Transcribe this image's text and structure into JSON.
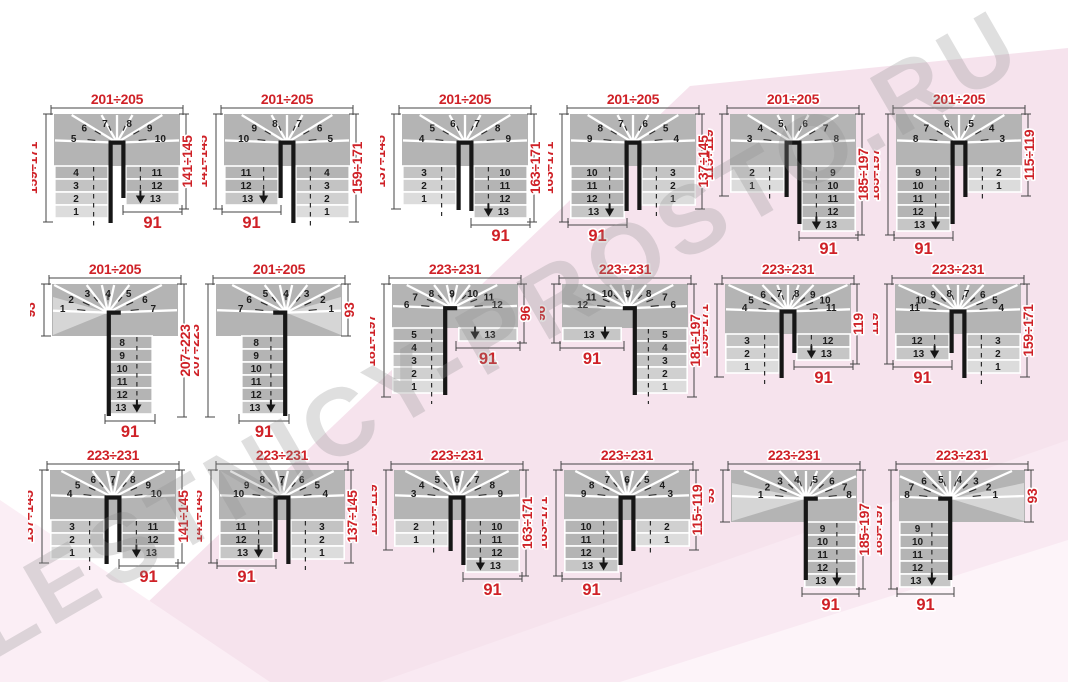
{
  "watermark": "LESTNICY-PROSTO.RU",
  "colors": {
    "red": "#cf2127",
    "step": "#b4b4b4",
    "step_light1": "#dcdcdc",
    "step_light2": "#d0d0d0",
    "step_light3": "#c3c3c3",
    "exit_step": "#c6c6c6",
    "wedge_light": "#d6d6d6",
    "black": "#161616",
    "pink": "#f6e3ed",
    "pink_light": "#fbeef5"
  },
  "diagrams": [
    {
      "id": "d1",
      "kind": "U",
      "pos": [
        32,
        84
      ],
      "band_h": 52,
      "winders": [
        5,
        6,
        7,
        8,
        9,
        10
      ],
      "left_rows": [
        4,
        3,
        2,
        1
      ],
      "left_exit": false,
      "right_rows": [
        11,
        12
      ],
      "right_exit": true,
      "exit_step": 13,
      "dims": {
        "top": "201÷205",
        "left": "159÷171",
        "right": "141÷145",
        "bottom": "91"
      }
    },
    {
      "id": "d2",
      "kind": "U",
      "pos": [
        202,
        84
      ],
      "band_h": 52,
      "winders": [
        10,
        9,
        8,
        7,
        6,
        5
      ],
      "left_rows": [
        11,
        12
      ],
      "left_exit": true,
      "right_rows": [
        4,
        3,
        2,
        1
      ],
      "right_exit": false,
      "exit_step": 13,
      "dims": {
        "top": "201÷205",
        "left": "141÷145",
        "right": "159÷171",
        "bottom": "91"
      }
    },
    {
      "id": "d3",
      "kind": "U",
      "pos": [
        380,
        84
      ],
      "band_h": 52,
      "winders": [
        4,
        5,
        6,
        7,
        8,
        9
      ],
      "left_rows": [
        3,
        2,
        1
      ],
      "left_exit": false,
      "right_rows": [
        10,
        11,
        12
      ],
      "right_exit": true,
      "exit_step": 13,
      "dims": {
        "top": "201÷205",
        "left": "137÷145",
        "right": "163÷171",
        "bottom": "91"
      }
    },
    {
      "id": "d4",
      "kind": "U",
      "pos": [
        548,
        84
      ],
      "band_h": 52,
      "winders": [
        9,
        8,
        7,
        6,
        5,
        4
      ],
      "left_rows": [
        10,
        11,
        12
      ],
      "left_exit": true,
      "right_rows": [
        3,
        2,
        1
      ],
      "right_exit": false,
      "exit_step": 13,
      "dims": {
        "top": "201÷205",
        "left": "163÷171",
        "right": "137÷145",
        "bottom": "91"
      }
    },
    {
      "id": "d5",
      "kind": "U",
      "pos": [
        708,
        84
      ],
      "band_h": 52,
      "winders": [
        3,
        4,
        5,
        6,
        7,
        8
      ],
      "left_rows": [
        2,
        1
      ],
      "left_exit": false,
      "right_rows": [
        9,
        10,
        11,
        12
      ],
      "right_exit": true,
      "exit_step": 13,
      "dims": {
        "top": "201÷205",
        "left": "115÷119",
        "right": "185÷197",
        "bottom": "91"
      }
    },
    {
      "id": "d6",
      "kind": "U",
      "pos": [
        874,
        84
      ],
      "band_h": 52,
      "winders": [
        8,
        7,
        6,
        5,
        4,
        3
      ],
      "left_rows": [
        9,
        10,
        11,
        12
      ],
      "left_exit": true,
      "right_rows": [
        2,
        1
      ],
      "right_exit": false,
      "exit_step": 13,
      "dims": {
        "top": "201÷205",
        "left": "185÷197",
        "right": "115÷119",
        "bottom": "91"
      }
    },
    {
      "id": "d7",
      "kind": "Lh",
      "pos": [
        30,
        254
      ],
      "band_h": 52,
      "winders": [
        1,
        2,
        3,
        4,
        5,
        6,
        7
      ],
      "flight_side": "right",
      "flight_rows": [
        8,
        9,
        10,
        11,
        12
      ],
      "light_entry": "left",
      "exit_step": 13,
      "dims": {
        "top": "201÷205",
        "left": "93",
        "right": "207÷223",
        "bottom": "91"
      }
    },
    {
      "id": "d8",
      "kind": "Lh",
      "pos": [
        194,
        254
      ],
      "band_h": 52,
      "winders": [
        7,
        6,
        5,
        4,
        3,
        2,
        1
      ],
      "flight_side": "left",
      "flight_rows": [
        8,
        9,
        10,
        11,
        12
      ],
      "light_entry": "right",
      "exit_step": 13,
      "dims": {
        "top": "201÷205",
        "left": "207÷223",
        "right": "93",
        "bottom": "91"
      }
    },
    {
      "id": "d9",
      "kind": "Lv",
      "pos": [
        370,
        254
      ],
      "band_h": 44,
      "winders": [
        6,
        7,
        8,
        9,
        10,
        11,
        12
      ],
      "col_side": "left",
      "col_rows": [
        5,
        4,
        3,
        2,
        1
      ],
      "exit_side": "right",
      "exit_step": 13,
      "dims": {
        "top": "223÷231",
        "left": "181÷197",
        "right": "96",
        "bottom": "91"
      }
    },
    {
      "id": "d10",
      "kind": "Lv",
      "pos": [
        540,
        254
      ],
      "band_h": 44,
      "winders": [
        12,
        11,
        10,
        9,
        8,
        7,
        6
      ],
      "col_side": "right",
      "col_rows": [
        5,
        4,
        3,
        2,
        1
      ],
      "exit_side": "left",
      "exit_step": 13,
      "dims": {
        "top": "223÷231",
        "left": "96",
        "right": "181÷197",
        "bottom": "91"
      }
    },
    {
      "id": "d11",
      "kind": "U",
      "pos": [
        703,
        254
      ],
      "band_h": 50,
      "winders": [
        4,
        5,
        6,
        7,
        8,
        9,
        10,
        11
      ],
      "left_rows": [
        3,
        2,
        1
      ],
      "left_exit": false,
      "right_rows": [
        12
      ],
      "right_exit": true,
      "exit_step": 13,
      "dims": {
        "top": "223÷231",
        "left": "159÷171",
        "right": "119",
        "bottom": "91"
      }
    },
    {
      "id": "d12",
      "kind": "U",
      "pos": [
        873,
        254
      ],
      "band_h": 50,
      "winders": [
        11,
        10,
        9,
        8,
        7,
        6,
        5,
        4
      ],
      "left_rows": [
        12
      ],
      "left_exit": true,
      "right_rows": [
        3,
        2,
        1
      ],
      "right_exit": false,
      "exit_step": 13,
      "dims": {
        "top": "223÷231",
        "left": "119",
        "right": "159÷171",
        "bottom": "91"
      }
    },
    {
      "id": "d13",
      "kind": "U",
      "pos": [
        28,
        440
      ],
      "band_h": 50,
      "winders": [
        4,
        5,
        6,
        7,
        8,
        9,
        10
      ],
      "left_rows": [
        3,
        2,
        1
      ],
      "left_exit": false,
      "right_rows": [
        11,
        12
      ],
      "right_exit": true,
      "exit_step": 13,
      "dims": {
        "top": "223÷231",
        "left": "137÷145",
        "right": "141÷145",
        "bottom": "91"
      }
    },
    {
      "id": "d14",
      "kind": "U",
      "pos": [
        197,
        440
      ],
      "band_h": 50,
      "winders": [
        10,
        9,
        8,
        7,
        6,
        5,
        4
      ],
      "left_rows": [
        11,
        12
      ],
      "left_exit": true,
      "right_rows": [
        3,
        2,
        1
      ],
      "right_exit": false,
      "exit_step": 13,
      "dims": {
        "top": "223÷231",
        "left": "141÷145",
        "right": "137÷145",
        "bottom": "91"
      }
    },
    {
      "id": "d15",
      "kind": "U",
      "pos": [
        372,
        440
      ],
      "band_h": 50,
      "winders": [
        3,
        4,
        5,
        6,
        7,
        8,
        9
      ],
      "left_rows": [
        2,
        1
      ],
      "left_exit": false,
      "right_rows": [
        10,
        11,
        12
      ],
      "right_exit": true,
      "exit_step": 13,
      "dims": {
        "top": "223÷231",
        "left": "115÷119",
        "right": "163÷171",
        "bottom": "91"
      }
    },
    {
      "id": "d16",
      "kind": "U",
      "pos": [
        542,
        440
      ],
      "band_h": 50,
      "winders": [
        9,
        8,
        7,
        6,
        5,
        4,
        3
      ],
      "left_rows": [
        10,
        11,
        12
      ],
      "left_exit": true,
      "right_rows": [
        2,
        1
      ],
      "right_exit": false,
      "exit_step": 13,
      "dims": {
        "top": "223÷231",
        "left": "163÷171",
        "right": "115÷119",
        "bottom": "91"
      }
    },
    {
      "id": "d17",
      "kind": "Rv",
      "pos": [
        709,
        440
      ],
      "band_h": 52,
      "winders": [
        1,
        2,
        3,
        4,
        5,
        6,
        7,
        8
      ],
      "col_side": "right",
      "col_rows": [
        9,
        10,
        11,
        12
      ],
      "light_entry": "left",
      "exit_step": 13,
      "dims": {
        "top": "223÷231",
        "left": "93",
        "right": "185÷197",
        "bottom": "91"
      }
    },
    {
      "id": "d18",
      "kind": "Rv",
      "pos": [
        877,
        440
      ],
      "band_h": 52,
      "winders": [
        8,
        7,
        6,
        5,
        4,
        3,
        2,
        1
      ],
      "col_side": "left",
      "col_rows": [
        9,
        10,
        11,
        12
      ],
      "light_entry": "right",
      "exit_step": 13,
      "dims": {
        "top": "223÷231",
        "left": "185÷197",
        "right": "93",
        "bottom": "91"
      }
    }
  ]
}
